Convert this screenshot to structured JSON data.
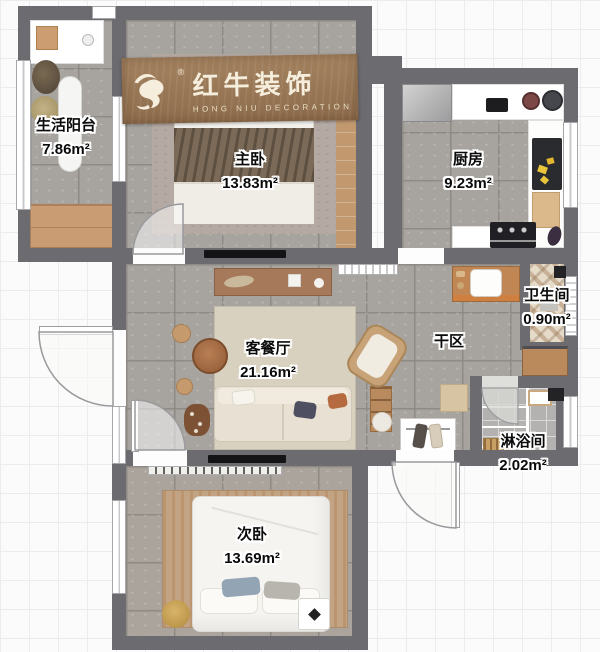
{
  "logo": {
    "brand_cn": "红牛装饰",
    "brand_en": "HONG NIU DECORATION",
    "registered_mark": "®"
  },
  "rooms": [
    {
      "id": "life-balcony",
      "name": "生活阳台",
      "area": "7.86m²"
    },
    {
      "id": "master-bedroom",
      "name": "主卧",
      "area": "13.83m²"
    },
    {
      "id": "kitchen",
      "name": "厨房",
      "area": "9.23m²"
    },
    {
      "id": "bathroom",
      "name": "卫生间",
      "area": "0.90m²"
    },
    {
      "id": "dry-area",
      "name": "干区"
    },
    {
      "id": "living-dining-room",
      "name": "客餐厅",
      "area": "21.16m²"
    },
    {
      "id": "shower-room",
      "name": "淋浴间",
      "area": "2.02m²"
    },
    {
      "id": "secondary-bedroom",
      "name": "次卧",
      "area": "13.69m²"
    }
  ],
  "colors": {
    "wall": "#6b6b70",
    "tile_floor": "#a7a39e",
    "banner_wood": "#9a7a58",
    "master_rug": "#b5a9a3",
    "living_rug": "#d8d1c0",
    "secondary_rug": "#c2a384",
    "bath_tile": "#e6dac8",
    "wood_accent": "#c08654"
  }
}
